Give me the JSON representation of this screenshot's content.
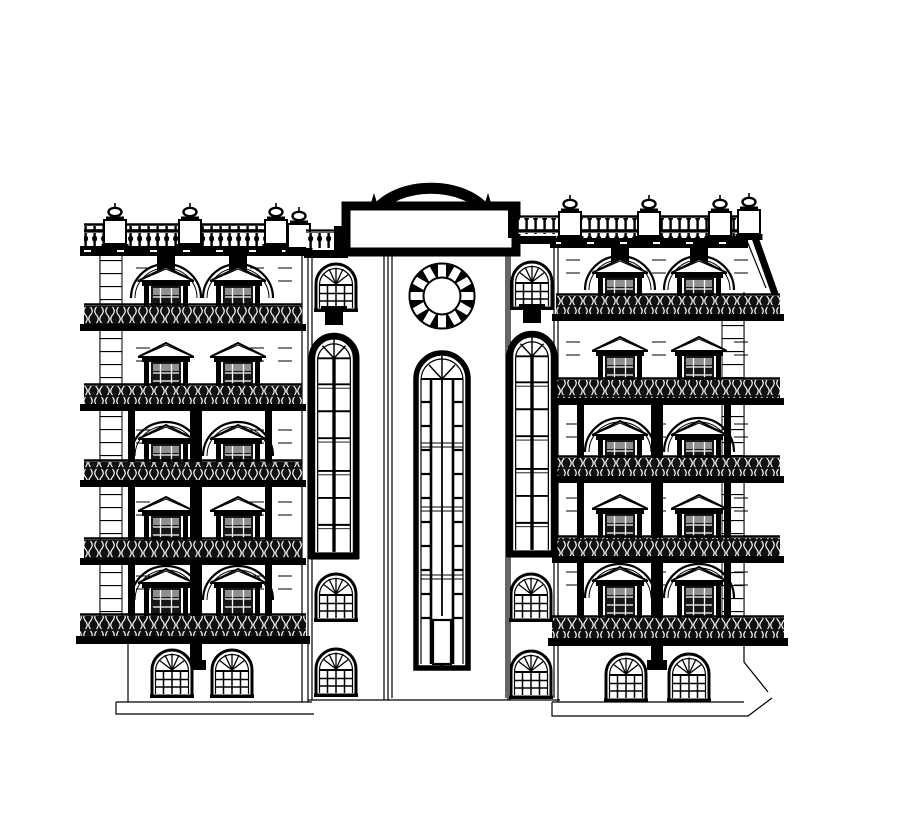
{
  "meta": {
    "title": "Front elevation drawing of a symmetrical five-storey classical building facade, black ink line work on white paper",
    "drawing_type": "architectural-elevation",
    "text_content": "none (drawing contains no legible text)"
  },
  "palette": {
    "paper": "#ffffff",
    "ink": "#000000",
    "sash_dark": "#161616",
    "transom_gray": "#8f8f8f",
    "ironwork_dark": "#101010"
  },
  "inventory": {
    "storeys": 6,
    "pedimented_windows": 20,
    "arched_recesses": 12,
    "small_arched_windows": 10,
    "tall_arched_windows": 2,
    "central_tall_window": 1,
    "round_window": 1,
    "balcony_railings": 10,
    "full_width_balconies": 2,
    "roof_balustrade_posts": 8,
    "parapet_panel": 1,
    "mansard_slope": "right side only"
  },
  "elements": {
    "wings": [
      {
        "id": "left-wing",
        "quoin": {
          "x": 100,
          "y": 252,
          "w": 22,
          "h": 366
        },
        "roof": {
          "strip": {
            "x": 84,
            "w": 216,
            "y": 226
          },
          "cornice": {
            "x": 80,
            "y": 246,
            "w": 230,
            "h": 10
          },
          "posts": [
            {
              "cx": 115,
              "y": 202
            },
            {
              "cx": 190,
              "y": 202
            },
            {
              "cx": 276,
              "y": 202
            },
            {
              "cx": 299,
              "y": 206
            }
          ]
        },
        "stubs": {
          "y": 256,
          "h": 16,
          "cx": [
            166,
            238
          ]
        },
        "cols": [
          166,
          238
        ],
        "floors": [
          {
            "win_y": 266,
            "arched": true,
            "balcony": {
              "x": 84,
              "w": 218,
              "y": 306
            },
            "band": {
              "x": 80,
              "w": 226,
              "y": 324
            }
          },
          {
            "win_y": 342,
            "arched": false,
            "balcony": {
              "x": 84,
              "w": 218,
              "y": 386
            },
            "band": {
              "x": 80,
              "w": 226,
              "y": 404
            }
          },
          {
            "win_y": 424,
            "arched": true,
            "balcony": {
              "x": 84,
              "w": 218,
              "y": 462
            },
            "band": {
              "x": 80,
              "w": 226,
              "y": 480
            }
          },
          {
            "win_y": 496,
            "arched": false,
            "balcony": {
              "x": 84,
              "w": 218,
              "y": 540
            },
            "band": {
              "x": 80,
              "w": 226,
              "y": 558
            }
          },
          {
            "win_y": 568,
            "arched": true,
            "balcony": {
              "x": 80,
              "w": 226,
              "y": 616,
              "h": 20
            },
            "band": {
              "x": 76,
              "w": 234,
              "y": 636,
              "h": 8
            }
          }
        ],
        "pilaster": {
          "x": 190,
          "y": 402,
          "w": 12,
          "h": 258
        },
        "columns": [
          {
            "x": 128,
            "y": 408,
            "h": 210
          },
          {
            "x": 265,
            "y": 408,
            "h": 210
          }
        ],
        "ground": {
          "cx": [
            172,
            232
          ],
          "y": 646
        },
        "dash_x": [
          136,
          250,
          278
        ],
        "dash_rows": [
          268,
          281,
          348,
          361,
          430,
          443,
          502,
          515,
          576,
          589
        ]
      },
      {
        "id": "right-wing",
        "quoin": {
          "x": 722,
          "y": 300,
          "w": 22,
          "h": 320
        },
        "roof": {
          "strip": {
            "x": 556,
            "w": 192,
            "y": 218
          },
          "cornice": {
            "x": 550,
            "y": 238,
            "w": 198,
            "h": 10
          },
          "posts": [
            {
              "cx": 570,
              "y": 194
            },
            {
              "cx": 649,
              "y": 194
            },
            {
              "cx": 720,
              "y": 194
            },
            {
              "cx": 749,
              "y": 192
            }
          ],
          "mansard": "M748,218 L775,294",
          "mansard2": "M741,226 L766,288"
        },
        "stubs": {
          "y": 248,
          "h": 16,
          "cx": [
            620,
            699
          ]
        },
        "cols": [
          620,
          699
        ],
        "floors": [
          {
            "win_y": 258,
            "arched": true,
            "balcony": {
              "x": 556,
              "w": 224,
              "y": 296
            },
            "band": {
              "x": 552,
              "w": 232,
              "y": 314
            }
          },
          {
            "win_y": 336,
            "arched": false,
            "balcony": {
              "x": 556,
              "w": 224,
              "y": 380
            },
            "band": {
              "x": 552,
              "w": 232,
              "y": 398
            }
          },
          {
            "win_y": 420,
            "arched": true,
            "balcony": {
              "x": 556,
              "w": 224,
              "y": 458
            },
            "band": {
              "x": 552,
              "w": 232,
              "y": 476
            }
          },
          {
            "win_y": 494,
            "arched": false,
            "balcony": {
              "x": 556,
              "w": 224,
              "y": 538
            },
            "band": {
              "x": 552,
              "w": 232,
              "y": 556
            }
          },
          {
            "win_y": 566,
            "arched": true,
            "balcony": {
              "x": 552,
              "w": 232,
              "y": 618,
              "h": 20
            },
            "band": {
              "x": 548,
              "w": 240,
              "y": 638,
              "h": 8
            }
          }
        ],
        "pilaster": {
          "x": 651,
          "y": 398,
          "w": 12,
          "h": 262
        },
        "columns": [
          {
            "x": 577,
            "y": 404,
            "h": 216
          },
          {
            "x": 724,
            "y": 404,
            "h": 216
          }
        ],
        "ground": {
          "cx": [
            626,
            689
          ],
          "y": 650
        },
        "dash_x": [
          566,
          652,
          734
        ],
        "dash_rows": [
          260,
          273,
          342,
          355,
          424,
          437,
          498,
          511,
          572,
          585
        ]
      }
    ],
    "flanks": [
      {
        "id": "left-flank",
        "small_top": {
          "cx": 336,
          "y": 260
        },
        "pedestal": {
          "cx": 334,
          "y": 306
        },
        "tall": {
          "cx": 334,
          "y": 324
        },
        "small_mid": {
          "cx": 336,
          "y": 570
        },
        "small_low": {
          "cx": 336,
          "y": 645
        }
      },
      {
        "id": "right-flank",
        "small_top": {
          "cx": 532,
          "y": 258
        },
        "pedestal": {
          "cx": 532,
          "y": 304
        },
        "tall": {
          "cx": 532,
          "y": 322
        },
        "small_mid": {
          "cx": 531,
          "y": 570
        },
        "small_low": {
          "cx": 531,
          "y": 647
        }
      }
    ],
    "center": {
      "panel": {
        "x": 346,
        "y": 206,
        "w": 170,
        "h": 46,
        "sw": 9
      },
      "crest": {
        "d": "M374,213 C396,180 466,180 488,213"
      },
      "finials": [
        374,
        488
      ],
      "round": {
        "cx": 442,
        "cy": 296
      },
      "window": {
        "x": 412,
        "y": 346
      },
      "connectors": {
        "left": {
          "strip": {
            "x": 306,
            "w": 40,
            "y": 232,
            "h": 16
          },
          "band": {
            "x": 304,
            "w": 44,
            "y": 250,
            "h": 8
          }
        },
        "right": {
          "strip": {
            "x": 518,
            "w": 38,
            "y": 218,
            "h": 16
          },
          "band": {
            "x": 516,
            "w": 40,
            "y": 236,
            "h": 8
          }
        }
      },
      "steps": [
        {
          "x": 334,
          "y": 226,
          "w": 14,
          "h": 26
        },
        {
          "x": 508,
          "y": 210,
          "w": 10,
          "h": 28
        }
      ]
    }
  }
}
